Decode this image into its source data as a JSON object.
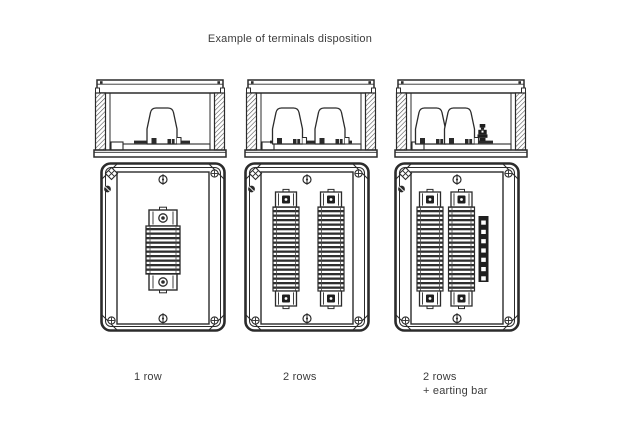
{
  "title": "Example of terminals disposition",
  "figure": {
    "description": "Technical line drawing: three enclosure variants shown as top cross-section and front view",
    "line_color": "#2b2b2b",
    "background": "#ffffff",
    "views": [
      {
        "label_lines": [
          "1 row"
        ],
        "terminal_rows": 1,
        "earthing_bar": false
      },
      {
        "label_lines": [
          "2 rows"
        ],
        "terminal_rows": 2,
        "earthing_bar": false
      },
      {
        "label_lines": [
          "2 rows",
          "+ earting bar"
        ],
        "terminal_rows": 2,
        "earthing_bar": true
      }
    ]
  }
}
